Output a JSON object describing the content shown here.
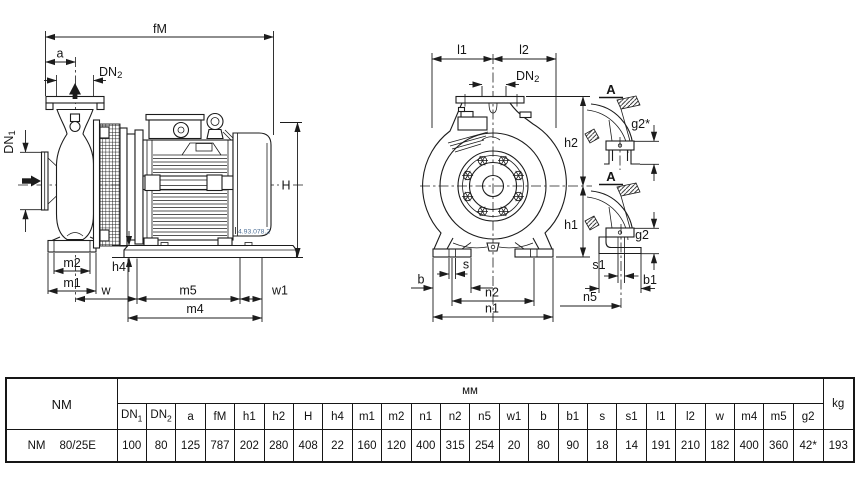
{
  "page": {
    "background": "#ffffff",
    "line_color": "#1c1c1c",
    "part_number_color": "#4d6f96"
  },
  "drawing": {
    "part_number": "4.93.078.2",
    "labels": {
      "fM": "fM",
      "a": "a",
      "dn_base": "DN",
      "dn1_sub": "1",
      "dn2_sub": "2",
      "H": "H",
      "h4": "h4",
      "m1": "m1",
      "m2": "m2",
      "w": "w",
      "w1": "w1",
      "m4": "m4",
      "m5": "m5",
      "l1": "l1",
      "l2": "l2",
      "h1": "h1",
      "h2": "h2",
      "b": "b",
      "s": "s",
      "n1": "n1",
      "n2": "n2",
      "n5": "n5",
      "s1": "s1",
      "b1": "b1",
      "g2": "g2",
      "g2_star": "g2*",
      "section_a": "A"
    }
  },
  "table": {
    "series_header": "NM",
    "unit_header": "мм",
    "weight_header": "kg",
    "columns": [
      {
        "base": "DN",
        "sub": "1"
      },
      {
        "base": "DN",
        "sub": "2"
      },
      "a",
      "fM",
      "h1",
      "h2",
      "H",
      "h4",
      "m1",
      "m2",
      "n1",
      "n2",
      "n5",
      "w1",
      "b",
      "b1",
      "s",
      "s1",
      "l1",
      "l2",
      "w",
      "m4",
      "m5",
      "g2"
    ],
    "rows": [
      {
        "series": "NM",
        "size": "80/25E",
        "values": [
          "100",
          "80",
          "125",
          "787",
          "202",
          "280",
          "408",
          "22",
          "160",
          "120",
          "400",
          "315",
          "254",
          "20",
          "80",
          "90",
          "18",
          "14",
          "191",
          "210",
          "182",
          "400",
          "360",
          "42*"
        ],
        "weight": "193"
      }
    ]
  }
}
